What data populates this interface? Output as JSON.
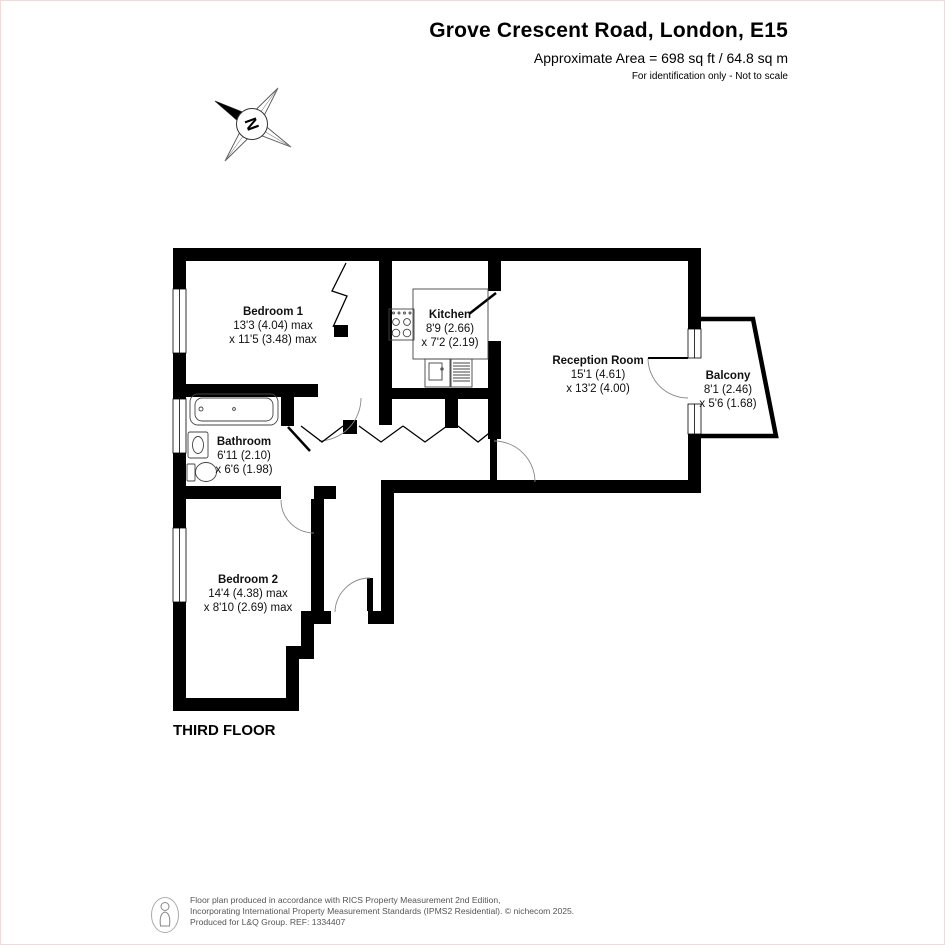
{
  "header": {
    "title": "Grove Crescent Road, London, E15",
    "subtitle": "Approximate Area = 698 sq ft / 64.8 sq m",
    "note": "For identification only - Not to scale"
  },
  "compass": {
    "north_label": "N"
  },
  "floor_plan": {
    "floor_label": "THIRD FLOOR",
    "rooms": [
      {
        "id": "bedroom-1",
        "name": "Bedroom 1",
        "size_line1": "13'3 (4.04) max",
        "size_line2": "x 11'5 (3.48) max"
      },
      {
        "id": "kitchen",
        "name": "Kitchen",
        "size_line1": "8'9 (2.66)",
        "size_line2": "x 7'2 (2.19)"
      },
      {
        "id": "reception-room",
        "name": "Reception Room",
        "size_line1": "15'1 (4.61)",
        "size_line2": "x 13'2 (4.00)"
      },
      {
        "id": "balcony",
        "name": "Balcony",
        "size_line1": "8'1 (2.46)",
        "size_line2": "x 5'6 (1.68)"
      },
      {
        "id": "bathroom",
        "name": "Bathroom",
        "size_line1": "6'11 (2.10)",
        "size_line2": "x 6'6 (1.98)"
      },
      {
        "id": "bedroom-2",
        "name": "Bedroom  2",
        "size_line1": "14'4 (4.38) max",
        "size_line2": "x 8'10 (2.69) max"
      }
    ]
  },
  "footer": {
    "line1": "Floor plan produced in accordance with RICS Property Measurement 2nd Edition,",
    "line2": "Incorporating International Property Measurement Standards (IPMS2 Residential).   © nichecom 2025.",
    "line3": "Produced for L&Q Group.   REF: 1334407"
  },
  "colors": {
    "wall": "#000000",
    "text": "#111111",
    "footer_text": "#555555",
    "page_border": "#f3d9d9"
  }
}
